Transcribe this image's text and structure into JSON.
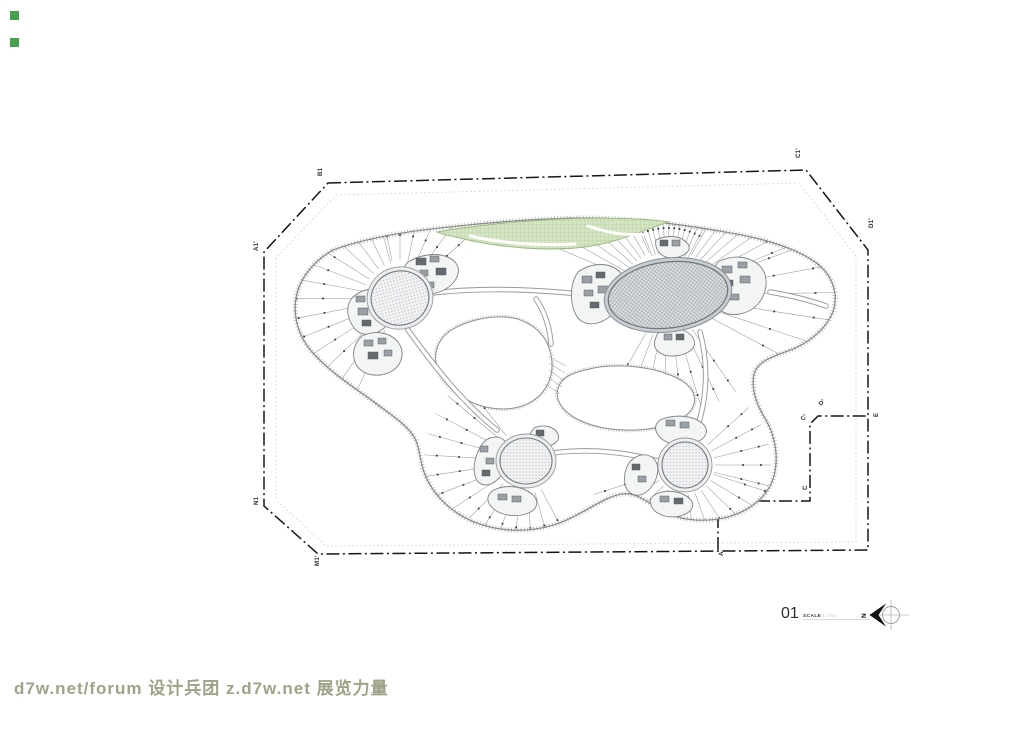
{
  "watermark": {
    "text": "d7w.net/forum 设计兵团 z.d7w.net 展览力量"
  },
  "titleblock": {
    "number": "01",
    "scale_label": "SCALE",
    "scale_value": "1:400",
    "north_letter": "N"
  },
  "colors": {
    "watermark": "#9da387",
    "wm-green": "#46a04c",
    "green-fill": "#d5e5c3",
    "green-line": "#aac694",
    "core-hatch-bg": "#dcdfe2",
    "core-hatch-line": "#8d9499",
    "boundary-black": "#161616",
    "line-gray": "#9a9a9a"
  },
  "plan": {
    "grid_labels": [
      {
        "t": "A1'",
        "x": 258,
        "y": 251,
        "r": -90
      },
      {
        "t": "B1",
        "x": 322,
        "y": 176,
        "r": -90
      },
      {
        "t": "C1'",
        "x": 800,
        "y": 158,
        "r": -90
      },
      {
        "t": "D1'",
        "x": 873,
        "y": 228,
        "r": -90
      },
      {
        "t": "E",
        "x": 878,
        "y": 417,
        "r": -90
      },
      {
        "t": "D'",
        "x": 821,
        "y": 406,
        "r": -45
      },
      {
        "t": "C'",
        "x": 803,
        "y": 421,
        "r": -45
      },
      {
        "t": "C",
        "x": 807,
        "y": 490,
        "r": -90
      },
      {
        "t": "B'",
        "x": 719,
        "y": 491,
        "r": -45
      },
      {
        "t": "A'",
        "x": 707,
        "y": 504,
        "r": -45
      },
      {
        "t": "A",
        "x": 723,
        "y": 556,
        "r": -90
      },
      {
        "t": "M1'",
        "x": 319,
        "y": 566,
        "r": -90
      },
      {
        "t": "N1",
        "x": 258,
        "y": 505,
        "r": -90
      }
    ],
    "boundary_points": "328,183 806,170 868,250 868,550 318,554 264,506 264,252",
    "setback_points": "336,195 799,183 856,256 856,542 326,546 276,500 276,258",
    "notch_points": "718,550 718,501 810,501 810,424 818,416 868,416",
    "fans": [
      {
        "cx": 400,
        "cy": 298,
        "r0": 36,
        "r1": 118,
        "a0": 115,
        "a1": 255,
        "n": 14
      },
      {
        "cx": 400,
        "cy": 298,
        "r0": 38,
        "r1": 88,
        "a0": 258,
        "a1": 318,
        "n": 6
      },
      {
        "cx": 668,
        "cy": 295,
        "r0": 46,
        "r1": 205,
        "a0": 203,
        "a1": 246,
        "n": 8
      },
      {
        "cx": 668,
        "cy": 295,
        "r0": 42,
        "r1": 92,
        "a0": 248,
        "a1": 298,
        "n": 12
      },
      {
        "cx": 668,
        "cy": 295,
        "r0": 46,
        "r1": 178,
        "a0": 300,
        "a1": 338,
        "n": 7
      },
      {
        "cx": 668,
        "cy": 295,
        "r0": 45,
        "r1": 170,
        "a0": -20,
        "a1": 28,
        "n": 6
      },
      {
        "cx": 668,
        "cy": 295,
        "r0": 42,
        "r1": 118,
        "a0": 55,
        "a1": 120,
        "n": 8
      },
      {
        "cx": 526,
        "cy": 461,
        "r0": 32,
        "r1": 102,
        "a0": 62,
        "a1": 232,
        "n": 15
      },
      {
        "cx": 685,
        "cy": 465,
        "r0": 30,
        "r1": 96,
        "a0": 18,
        "a1": 162,
        "n": 12
      },
      {
        "cx": 685,
        "cy": 465,
        "r0": 30,
        "r1": 86,
        "a0": -42,
        "a1": 14,
        "n": 5
      }
    ],
    "rooms": [
      [
        416,
        258,
        10,
        7
      ],
      [
        430,
        256,
        9,
        6
      ],
      [
        420,
        270,
        8,
        6
      ],
      [
        436,
        268,
        10,
        7
      ],
      [
        425,
        282,
        9,
        6
      ],
      [
        356,
        296,
        9,
        6
      ],
      [
        368,
        294,
        8,
        6
      ],
      [
        358,
        308,
        10,
        7
      ],
      [
        372,
        306,
        8,
        6
      ],
      [
        362,
        320,
        9,
        6
      ],
      [
        364,
        340,
        9,
        6
      ],
      [
        378,
        338,
        8,
        6
      ],
      [
        368,
        352,
        10,
        7
      ],
      [
        384,
        350,
        8,
        6
      ],
      [
        582,
        276,
        10,
        7
      ],
      [
        596,
        272,
        9,
        6
      ],
      [
        584,
        290,
        9,
        6
      ],
      [
        598,
        286,
        10,
        7
      ],
      [
        590,
        302,
        9,
        6
      ],
      [
        722,
        266,
        10,
        7
      ],
      [
        738,
        262,
        9,
        6
      ],
      [
        724,
        280,
        9,
        6
      ],
      [
        740,
        276,
        10,
        7
      ],
      [
        730,
        294,
        9,
        6
      ],
      [
        660,
        240,
        8,
        6
      ],
      [
        672,
        240,
        8,
        6
      ],
      [
        664,
        334,
        8,
        6
      ],
      [
        676,
        334,
        8,
        6
      ],
      [
        480,
        446,
        8,
        6
      ],
      [
        486,
        458,
        8,
        6
      ],
      [
        482,
        470,
        8,
        6
      ],
      [
        498,
        494,
        9,
        6
      ],
      [
        512,
        496,
        9,
        6
      ],
      [
        536,
        430,
        8,
        6
      ],
      [
        666,
        420,
        9,
        6
      ],
      [
        680,
        422,
        9,
        6
      ],
      [
        632,
        464,
        8,
        6
      ],
      [
        638,
        476,
        8,
        6
      ],
      [
        660,
        496,
        9,
        6
      ],
      [
        674,
        498,
        9,
        6
      ]
    ]
  }
}
